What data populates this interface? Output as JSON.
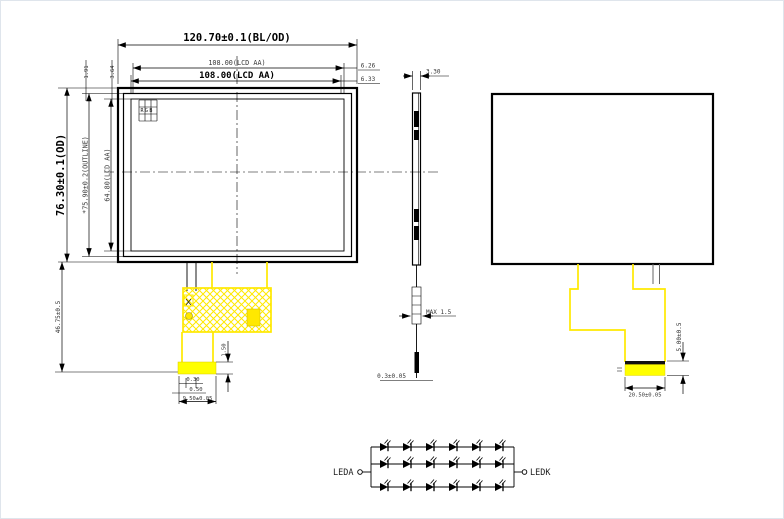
{
  "drawing": {
    "front_view": {
      "dim_bl_od": "120.70±0.1(BL/OD)",
      "dim_lcd_top_small": "108.00(LCD AA)",
      "dim_lcd_aa_top": "108.00(LCD AA)",
      "dim_right_gap_top": "6.26",
      "dim_right_gap_bottom": "6.33",
      "dim_od_left": "76.30±0.1(OD)",
      "dim_outline_left": "*75.90±0.2(OUTLINE)",
      "dim_aa_left": "64.80(LCD AA)",
      "dim_top_margin_1": "1.91",
      "dim_top_margin_2": "3.64",
      "dim_fpc_length": "46.75±0.5",
      "pixel_marker": "RGB",
      "dim_tab_offset": "0.30",
      "dim_tab_pitch": "0.50",
      "dim_tab_width": "9.50±0.05",
      "dim_tab_height": "1.50"
    },
    "side_view": {
      "dim_thickness": "3.30",
      "dim_fpc_bend": "MAX 1.5",
      "dim_fpc_thickness": "0.3±0.05"
    },
    "back_view": {
      "dim_tab_height": "5.00±0.5",
      "dim_tab_width": "20.50±0.05"
    },
    "led_circuit": {
      "anode_label": "LEDA",
      "cathode_label": "LEDK",
      "rows": 3,
      "leds_per_row": 6
    },
    "colors": {
      "fpc_highlight": "#ffff00",
      "line": "#000000"
    }
  }
}
